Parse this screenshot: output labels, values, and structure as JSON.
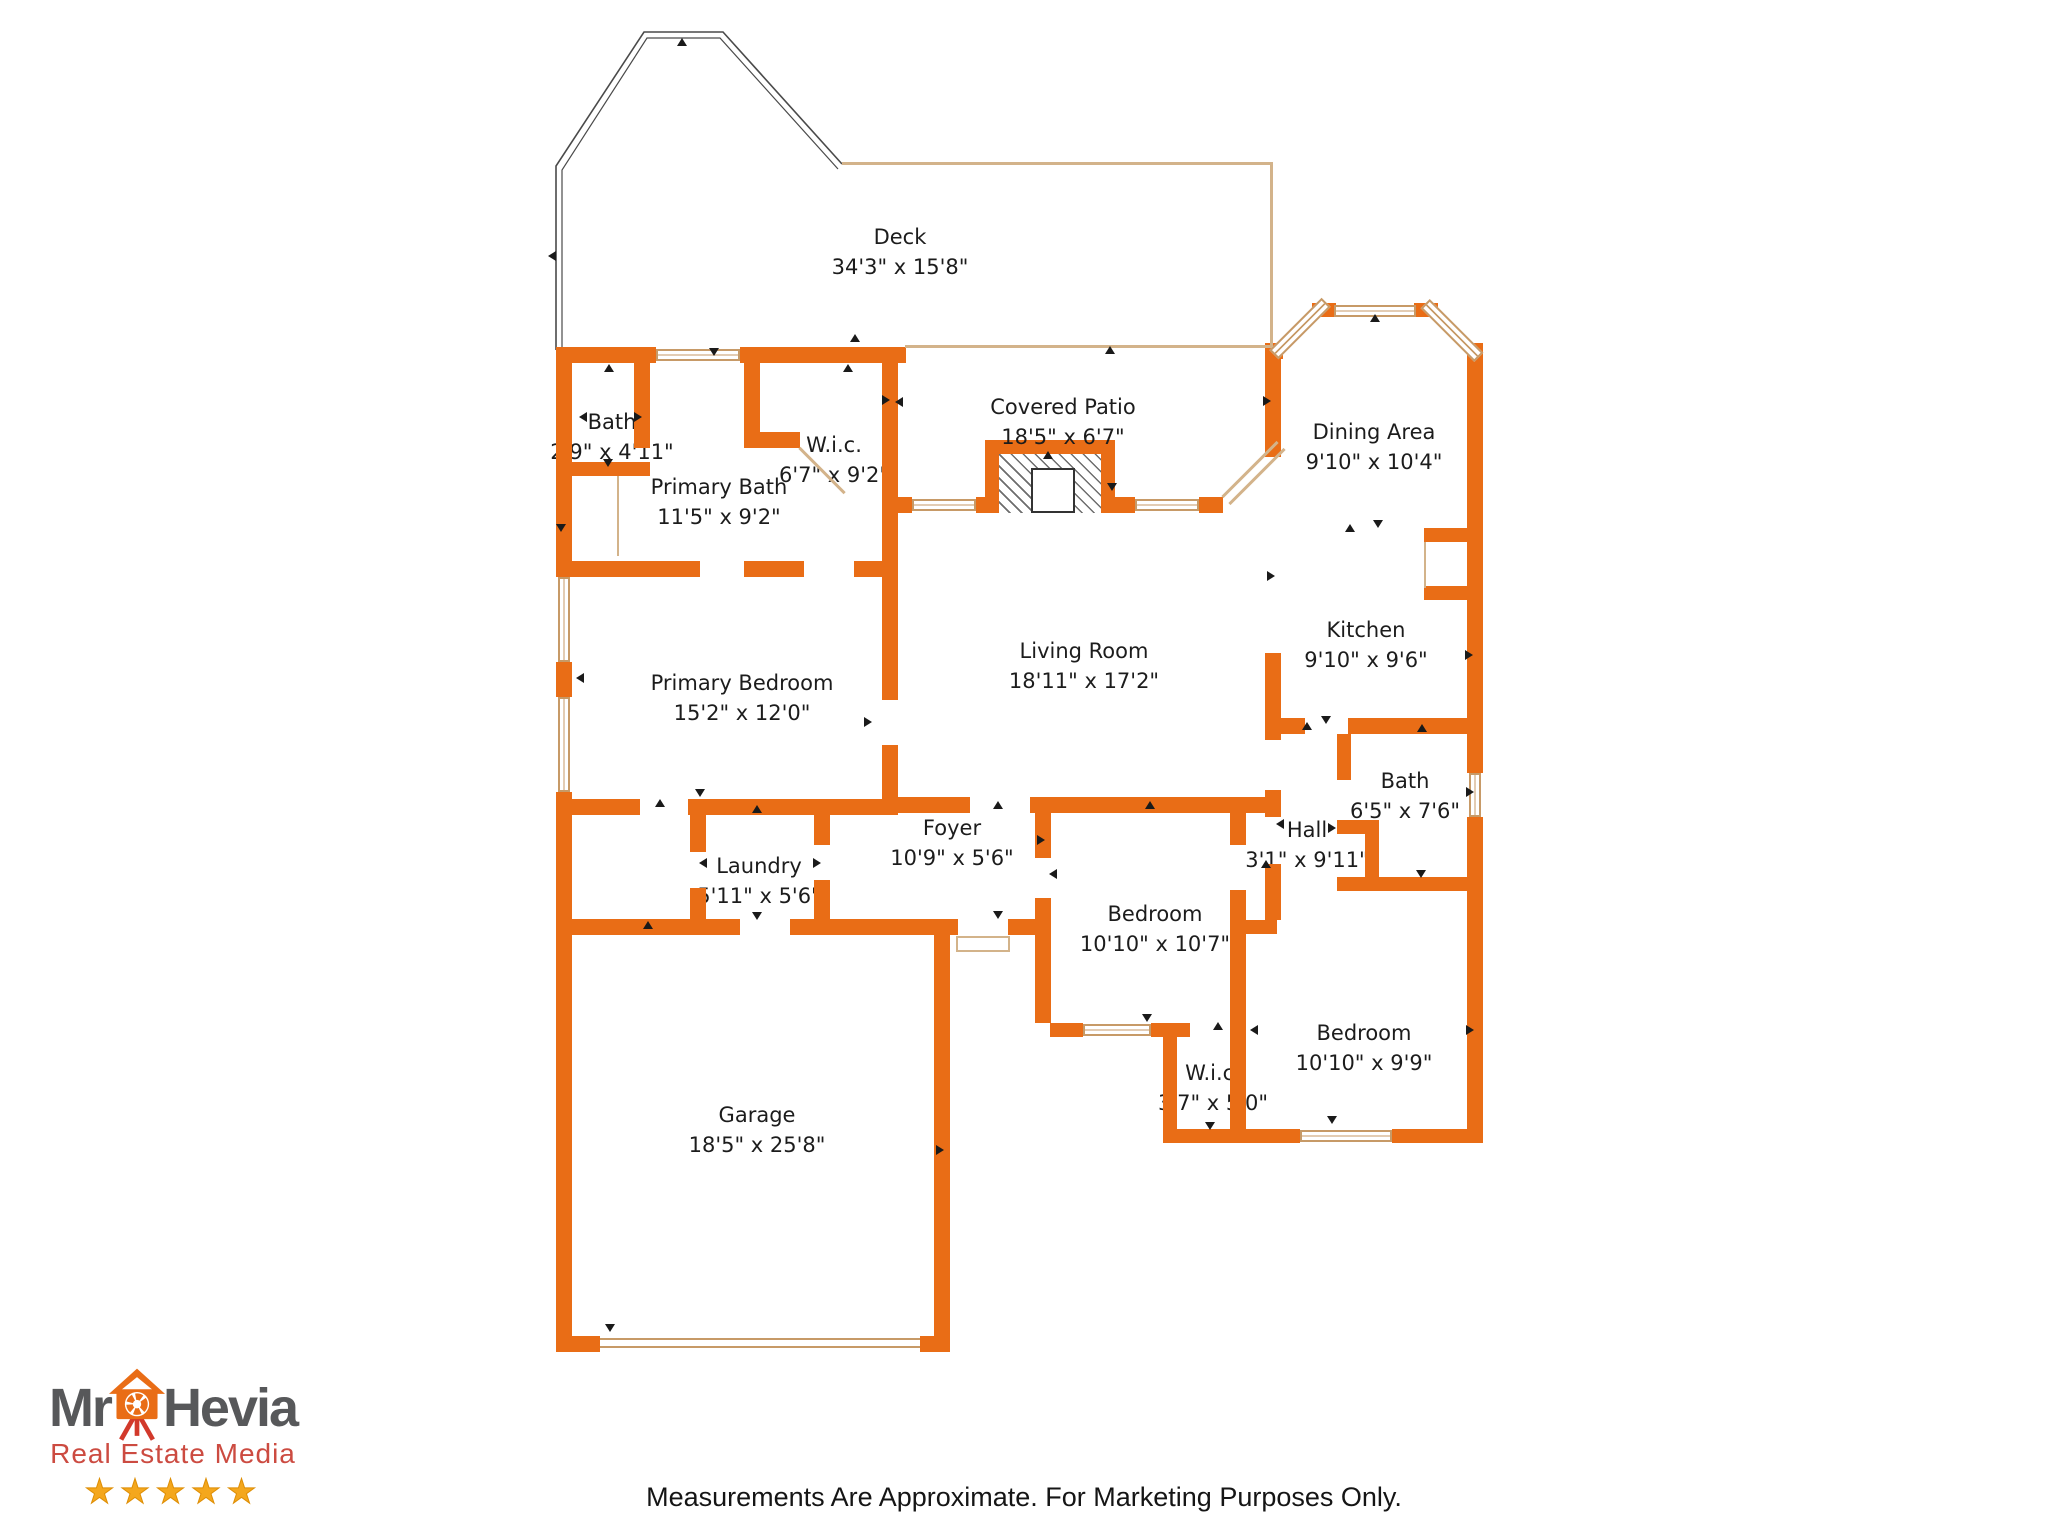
{
  "colors": {
    "wall": "#E96D16",
    "window_trim": "#C79A67",
    "patio_line": "#D3B38A",
    "deck_outline": "#4a4a4a",
    "text": "#1c1c1c",
    "logo_gray": "#57585A",
    "logo_red": "#CC4B41",
    "logo_house_orange": "#E96D16",
    "logo_tripod_red": "#D2392B",
    "star_gold": "#F4A71D"
  },
  "rooms": [
    {
      "name": "Deck",
      "dims": "34'3\" x 15'8\""
    },
    {
      "name": "Bath",
      "dims": "2'9\" x 4'11\""
    },
    {
      "name": "W.i.c.",
      "dims": "6'7\" x 9'2\""
    },
    {
      "name": "Primary Bath",
      "dims": "11'5\" x 9'2\""
    },
    {
      "name": "Covered Patio",
      "dims": "18'5\" x 6'7\""
    },
    {
      "name": "Dining Area",
      "dims": "9'10\" x 10'4\""
    },
    {
      "name": "Kitchen",
      "dims": "9'10\" x 9'6\""
    },
    {
      "name": "Living Room",
      "dims": "18'11\" x 17'2\""
    },
    {
      "name": "Primary Bedroom",
      "dims": "15'2\" x 12'0\""
    },
    {
      "name": "Bath",
      "dims": "6'5\" x 7'6\""
    },
    {
      "name": "Foyer",
      "dims": "10'9\" x 5'6\""
    },
    {
      "name": "Hall",
      "dims": "3'1\" x 9'11\""
    },
    {
      "name": "Laundry",
      "dims": "5'11\" x 5'6\""
    },
    {
      "name": "Bedroom",
      "dims": "10'10\" x 10'7\""
    },
    {
      "name": "Bedroom",
      "dims": "10'10\" x 9'9\""
    },
    {
      "name": "W.i.c.",
      "dims": "3'7\" x 5'0\""
    },
    {
      "name": "Garage",
      "dims": "18'5\" x 25'8\""
    }
  ],
  "logo": {
    "brand_first": "Mr",
    "brand_second": "Hevia",
    "tagline": "Real Estate Media",
    "stars": 5
  },
  "footer": {
    "disclaimer": "Measurements Are Approximate. For Marketing Purposes Only."
  }
}
